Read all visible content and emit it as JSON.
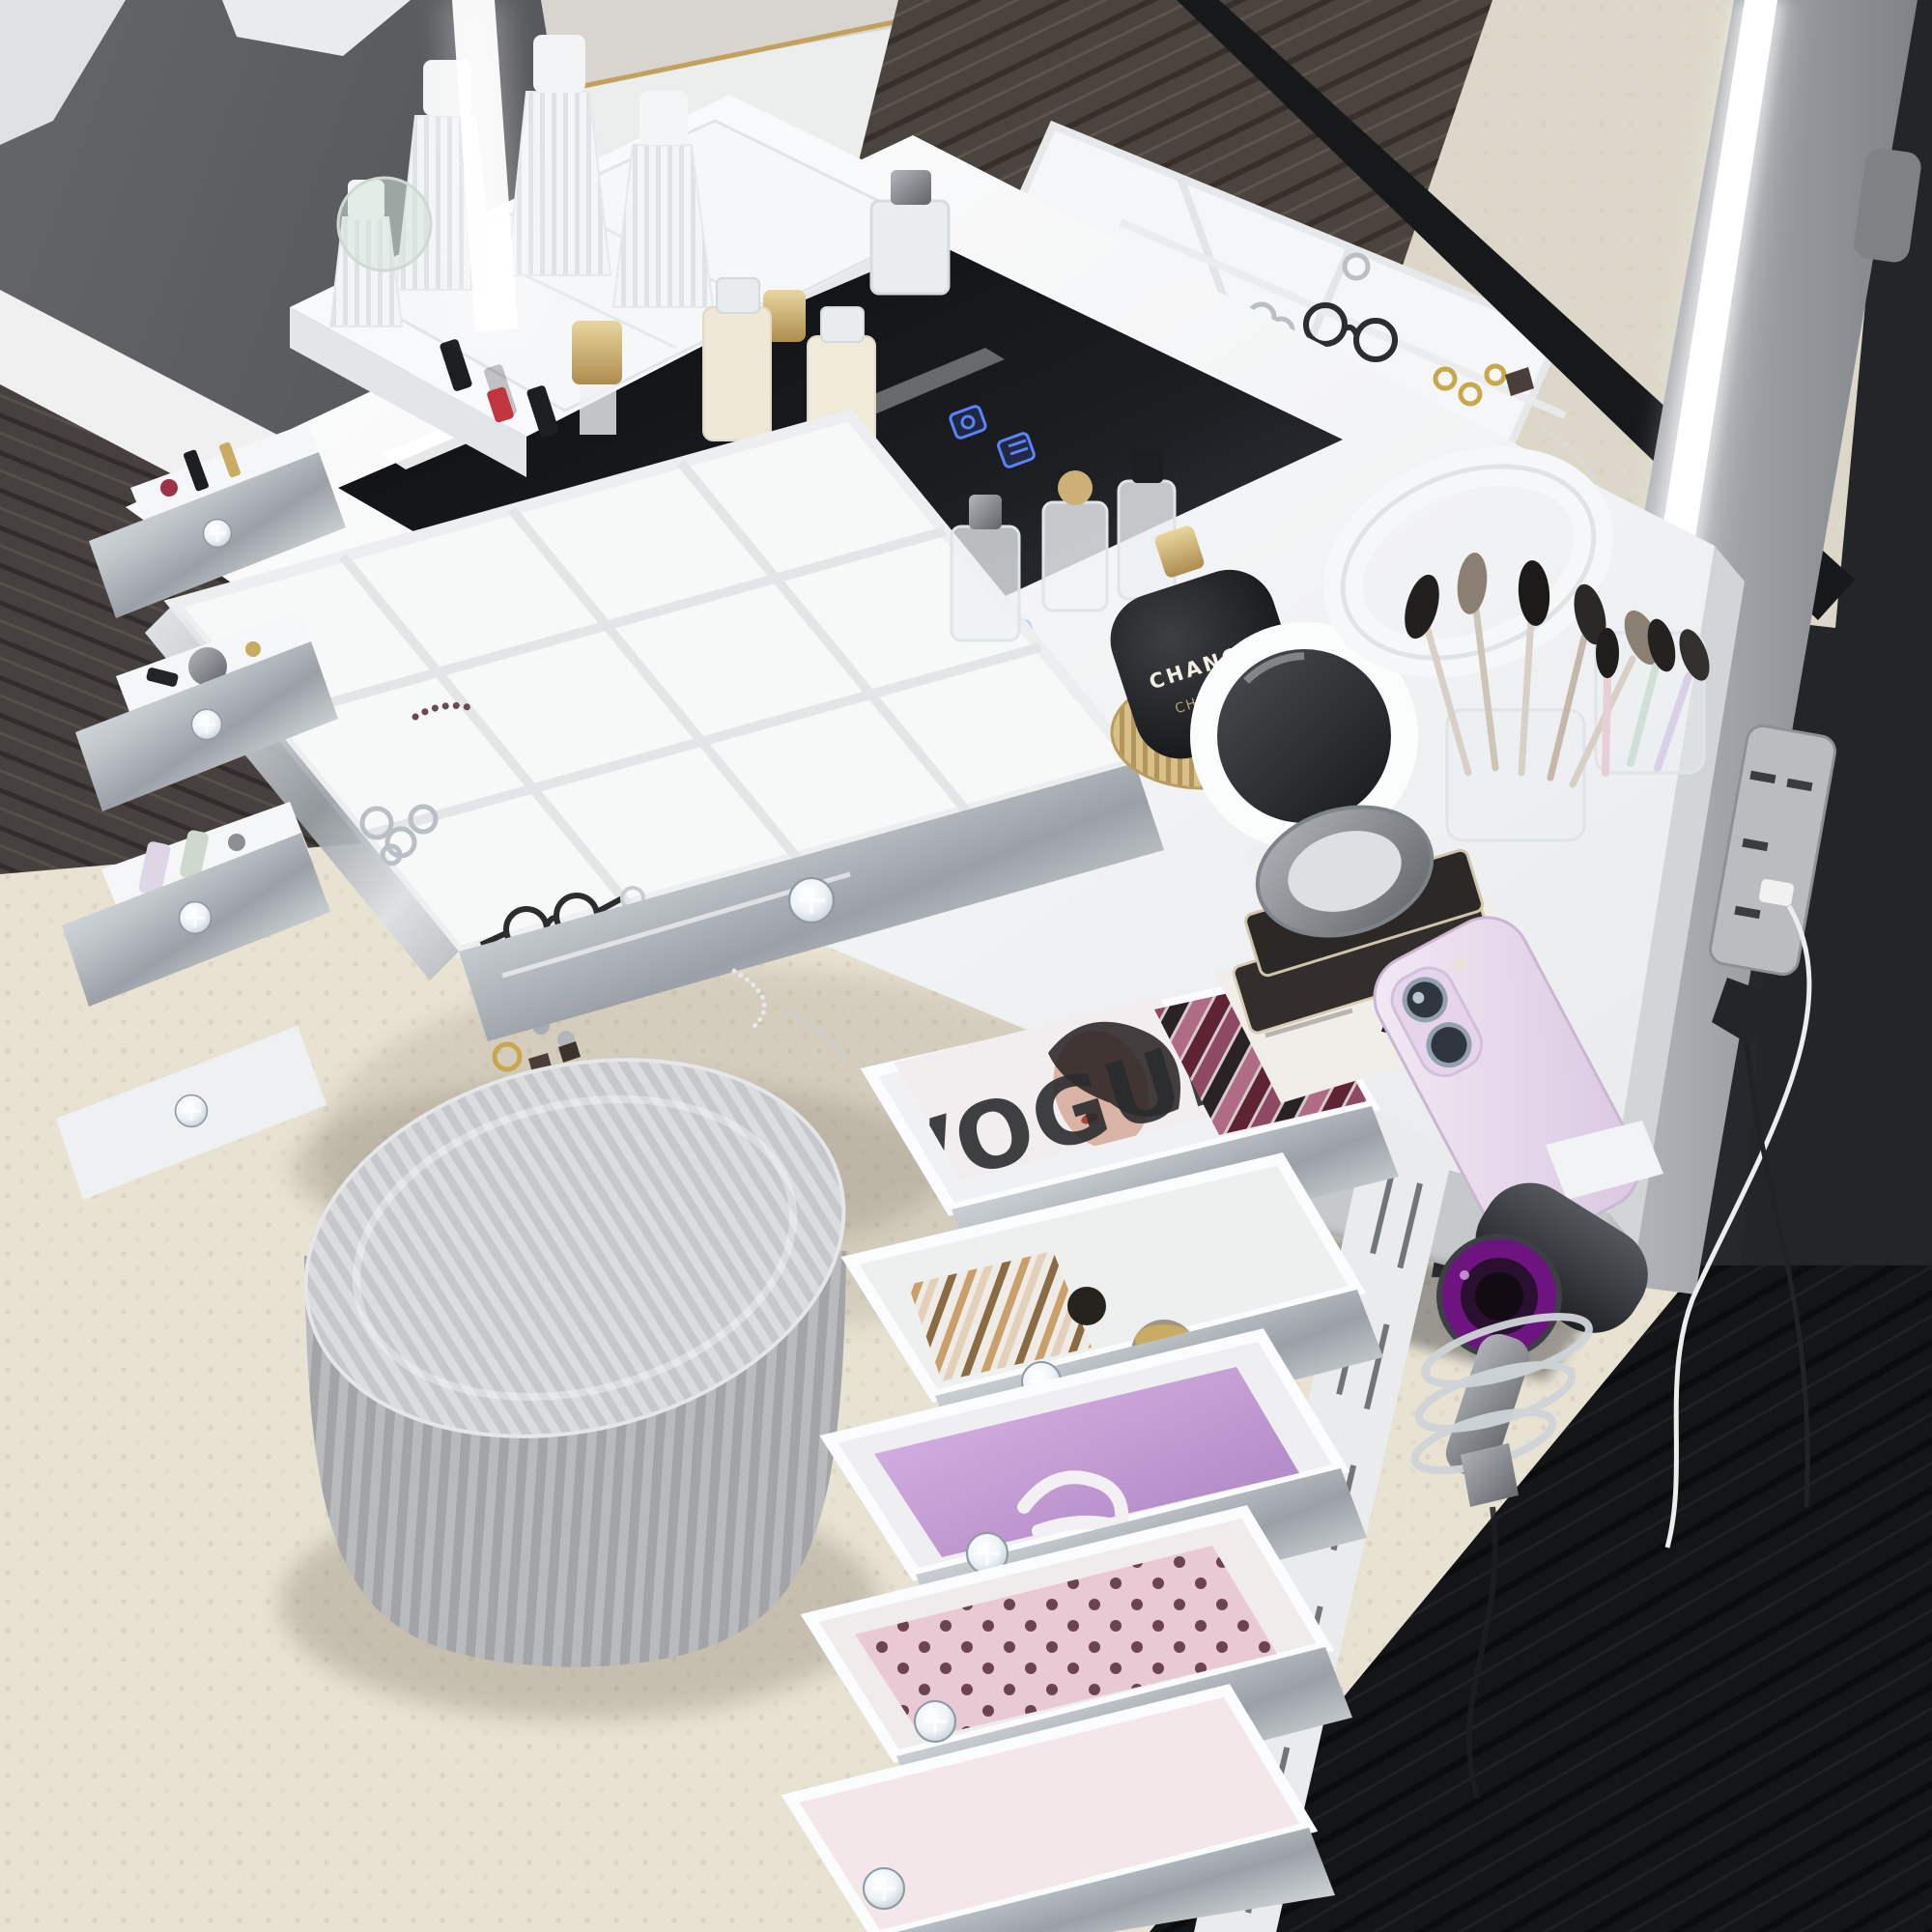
{
  "texts": {
    "perfume_line1": "CHANCE",
    "perfume_line2": "CHANEL",
    "magazine_title": "VOGUE",
    "magazine_title_reflection": "UE"
  },
  "palette": {
    "wall_gray": "#54565a",
    "wall_dark": "#2b2d30",
    "baseboard_white": "#eff0ef",
    "wood_floor": "#45403d",
    "wood_floor_dark": "#121415",
    "rug_cream": "#e8e2d3",
    "vanity_white": "#f7f8f9",
    "mirror_silver": "#c2c7cc",
    "glass_black": "#101214",
    "led_white": "#ffffff",
    "touch_icon_blue": "#5b82ff",
    "gold": "#c9ab64",
    "crystal_knob": "#e6ecf1",
    "ottoman_gray": "#bcbec0",
    "phone_lavender": "#e7d9eb",
    "dryer_purple": "#6d1480",
    "lipstick_plum": "#8e4a63",
    "drawer_liner_lilac": "#c9a0d6",
    "magazine_skin": "#d9b3a6"
  },
  "objects": [
    "dark-gray-wall",
    "white-baseboard",
    "picture-frame-corner",
    "dark-wood-floor",
    "cream-shag-rug",
    "white-vanity-table",
    "black-glass-tabletop-insert",
    "led-touch-icons",
    "top-shelf-acrylic-organizer",
    "fluted-perfume-bottles",
    "gold-cap-perfumes",
    "lipsticks",
    "serum-bottles",
    "jewelry-drawer-with-compartments",
    "eyeglasses",
    "silver-rings",
    "gold-rings",
    "beaded-bracelet",
    "stud-earrings",
    "drop-earrings",
    "necklace-chain",
    "left-drawer-stack",
    "right-drawer-stack",
    "crystal-drawer-knobs",
    "vogue-magazine",
    "lipstick-collection",
    "makeup-pencils",
    "cosmetic-jars",
    "lilac-drawer-liner",
    "hair-claw-clip",
    "pink-polka-pouch",
    "pleated-gray-ottoman",
    "chance-chanel-perfume",
    "round-vanity-mirror",
    "white-headband",
    "makeup-brushes",
    "acrylic-brush-holders",
    "eyeshadow-palette-stack",
    "silver-compact-mirror",
    "lavender-smartphone",
    "full-length-led-mirror",
    "led-light-strip",
    "mirror-frame",
    "wall-power-strip",
    "charging-cables",
    "hair-dryer",
    "spiral-dryer-holder"
  ]
}
